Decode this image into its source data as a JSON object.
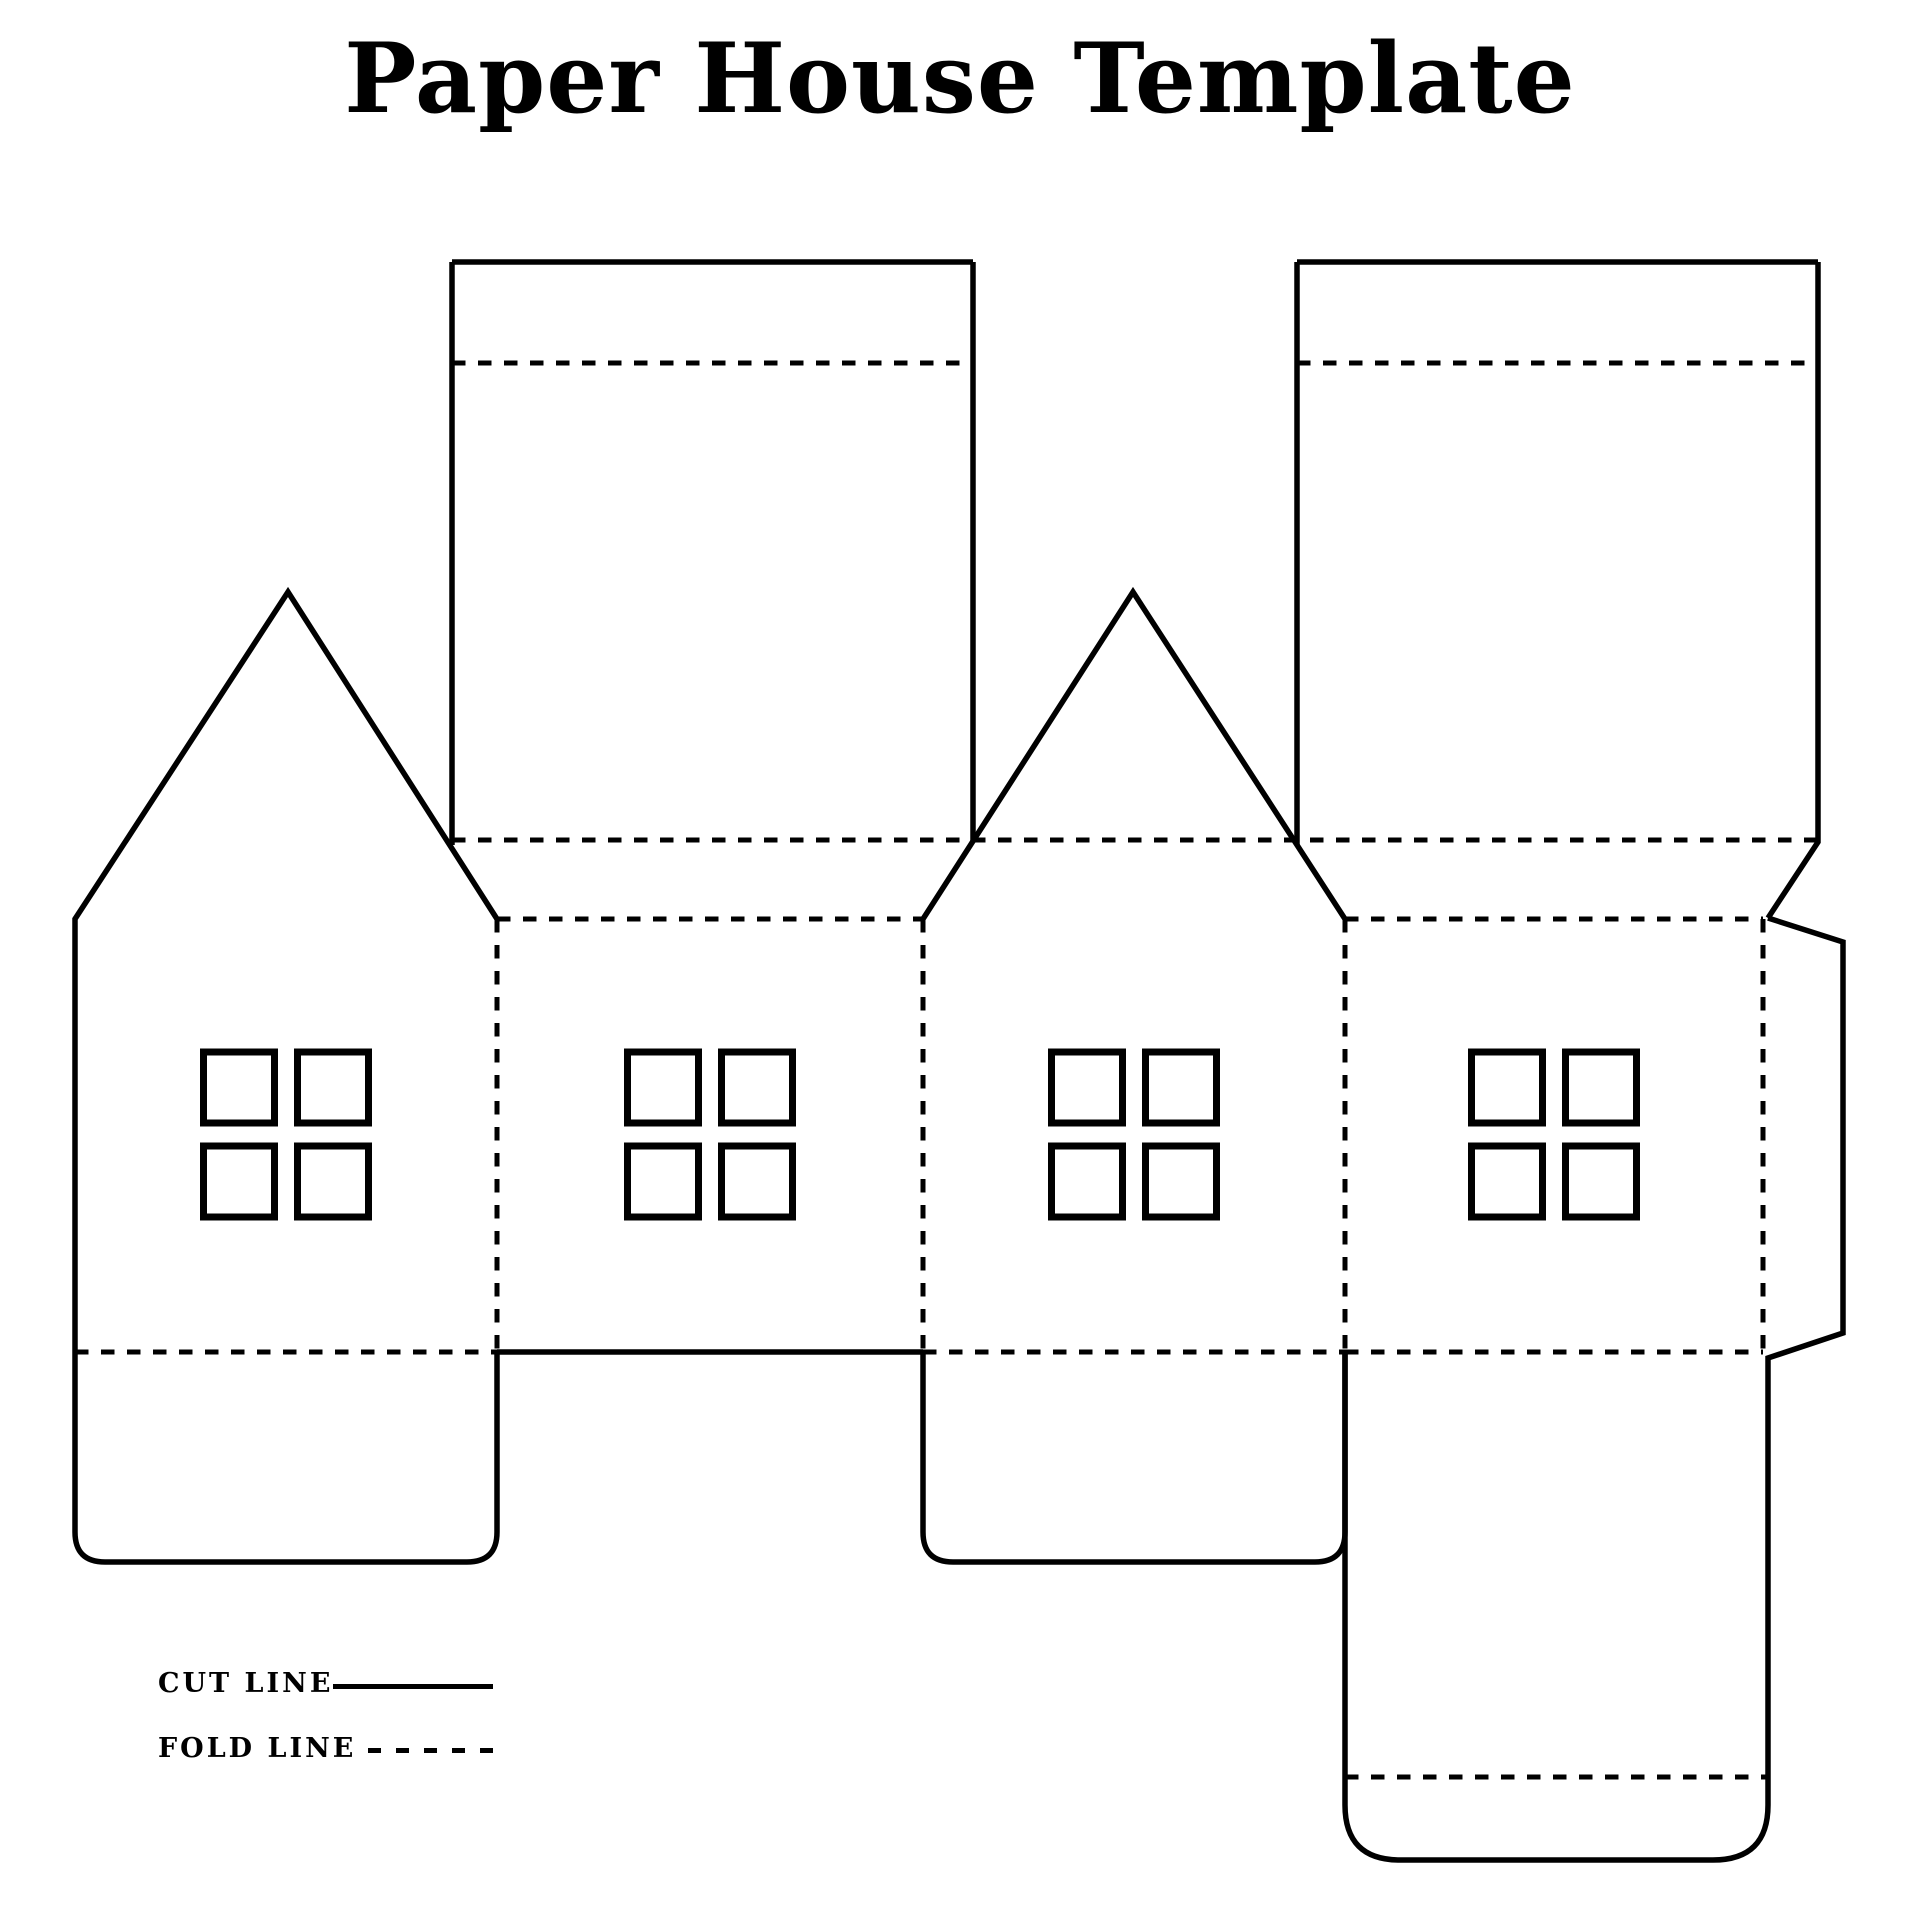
{
  "title": "Paper House Template",
  "legend": {
    "cut_label": "CUT LINE",
    "fold_label": "FOLD LINE"
  },
  "colors": {
    "line": "#000000",
    "background": "#ffffff"
  },
  "dieline": {
    "cut_width": 5.5,
    "fold_width": 5,
    "fold_dash": "13.5 12.5",
    "window_stroke": 7,
    "cut_paths": [
      {
        "name": "roof-panel-left",
        "d": "M452,262 H973 M452,262 V845 M973,262 V841"
      },
      {
        "name": "roof-panel-right",
        "d": "M1297,262 H1818 M1297,262 V845 M1818,262 V842 L1768,918"
      },
      {
        "name": "gable-wall-left-outline",
        "d": "M497,919 L288,592 L75,919 V1532 Q75,1562 105,1562 H467 Q497,1562 497,1532 V1352"
      },
      {
        "name": "gable-wall-middle-outline",
        "d": "M923,919 L1133,592 L1345,919"
      },
      {
        "name": "bottom-flap-middle",
        "d": "M923,1352 V1532 Q923,1562 953,1562 H1315 Q1345,1562 1345,1532 V1352"
      },
      {
        "name": "side-wall-bottom-edge",
        "d": "M497,1352 H923"
      },
      {
        "name": "glue-tab-and-base-outline",
        "d": "M1768,918 L1843,942 V1333 L1768,1358 V1805 Q1768,1860 1713,1860 H1400 Q1345,1860 1345,1805 V1352"
      }
    ],
    "fold_paths": [
      {
        "name": "roof-left-top-fold",
        "d": "M452,363 H973"
      },
      {
        "name": "roof-right-top-fold",
        "d": "M1297,363 H1818"
      },
      {
        "name": "eave-fold",
        "d": "M452,840 H1818"
      },
      {
        "name": "wall-b-top-fold",
        "d": "M497,919 H923"
      },
      {
        "name": "wall-d-top-fold",
        "d": "M1345,919 H1763"
      },
      {
        "name": "fold-a-b",
        "d": "M497,919 V1352"
      },
      {
        "name": "fold-b-c",
        "d": "M923,919 V1352"
      },
      {
        "name": "fold-c-d",
        "d": "M1345,919 V1352"
      },
      {
        "name": "fold-d-tab",
        "d": "M1763,919 V1352"
      },
      {
        "name": "flap-a-fold",
        "d": "M75,1352 H497"
      },
      {
        "name": "flap-c-fold",
        "d": "M923,1352 H1345"
      },
      {
        "name": "base-top-fold",
        "d": "M1345,1352 H1763"
      },
      {
        "name": "base-tuck-fold",
        "d": "M1345,1777 H1768"
      }
    ],
    "window_layout": {
      "cluster_centers_x": [
        286,
        710,
        1134,
        1554
      ],
      "row_tops_y": [
        1052,
        1146
      ],
      "col_offsets": [
        -82.5,
        11.5
      ],
      "pane_size": 71
    }
  }
}
